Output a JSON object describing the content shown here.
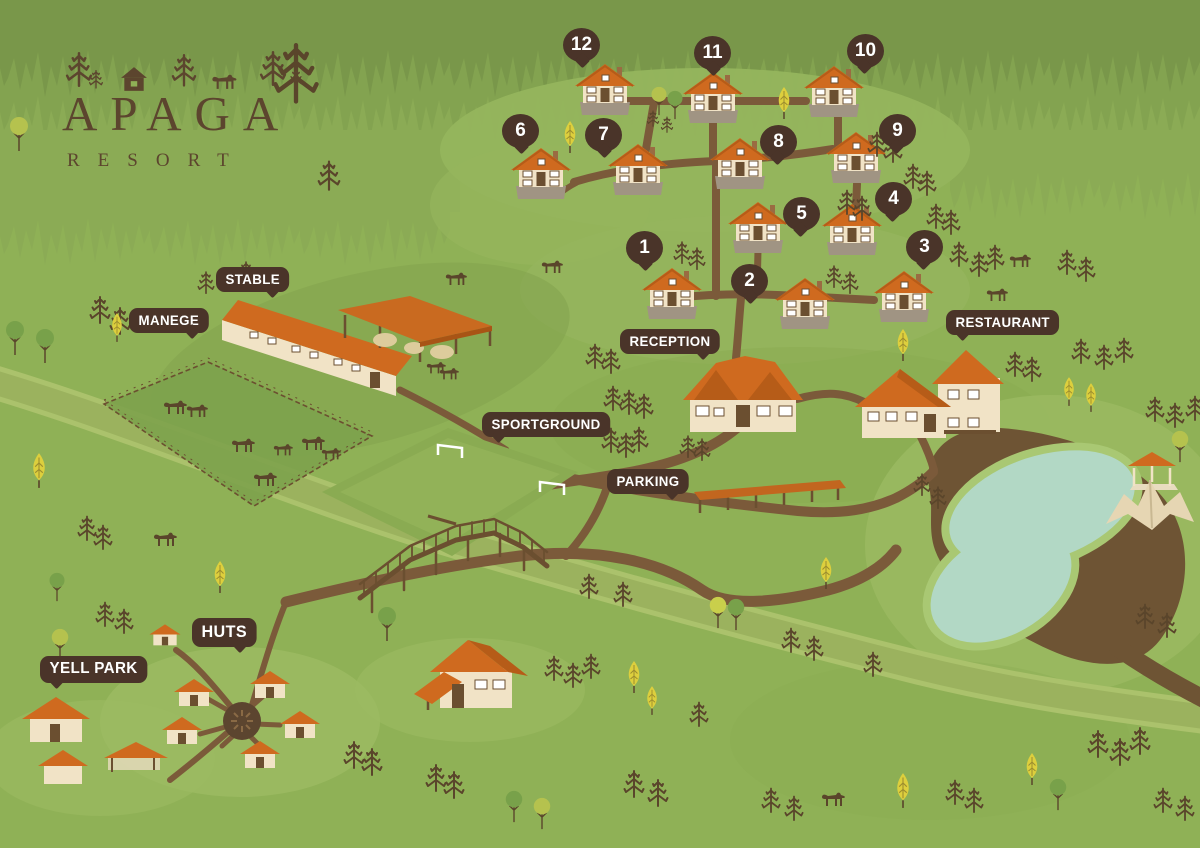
{
  "logo": {
    "title": "APAGA",
    "subtitle": "RESORT"
  },
  "cottages": {
    "items": [
      {
        "number": "1"
      },
      {
        "number": "2"
      },
      {
        "number": "3"
      },
      {
        "number": "4"
      },
      {
        "number": "5"
      },
      {
        "number": "6"
      },
      {
        "number": "7"
      },
      {
        "number": "8"
      },
      {
        "number": "9"
      },
      {
        "number": "10"
      },
      {
        "number": "11"
      },
      {
        "number": "12"
      }
    ]
  },
  "labels": {
    "stable": "STABLE",
    "manege": "MANEGE",
    "reception": "RECEPTION",
    "restaurant": "RESTAURANT",
    "sportground": "SPORTGROUND",
    "parking": "PARKING",
    "huts": "HUTS",
    "yell_park": "YELL PARK"
  },
  "palette": {
    "grass": "#8fb156",
    "grass_light": "#9cbb63",
    "grass_dark": "#7fa04c",
    "forest_dark": "#79974a",
    "forest_mid": "#83a350",
    "forest_light": "#8bab55",
    "path_brown": "#7b5a3a",
    "wood_dark": "#6b4f30",
    "bubble_brown": "#4a3429",
    "roof_orange": "#cf6a1f",
    "roof_shadow": "#b65c18",
    "wall_cream": "#f1e3c6",
    "base_gray": "#a09483",
    "water": "#b2d8c5",
    "water_rim": "#a9c873",
    "river_green": "#9bb25e",
    "tree_brown": "#5a452b",
    "tree_yellow": "#ddcf3d",
    "tree_green": "#78a14a",
    "hay": "#ddcc9c",
    "tent_beige": "#e6d6b3",
    "logo_brown": "#5c452e"
  },
  "icons": {
    "pine_tree": "pine-tree-icon",
    "deciduous_tree": "deciduous-tree-icon",
    "yellow_tree": "yellow-tree-icon",
    "cottage": "cottage-icon",
    "hut": "hut-icon",
    "horse": "horse-icon",
    "fire_pit": "fire-pit-icon",
    "bridge": "bridge-icon",
    "tent": "tent-icon",
    "gazebo": "gazebo-icon"
  }
}
